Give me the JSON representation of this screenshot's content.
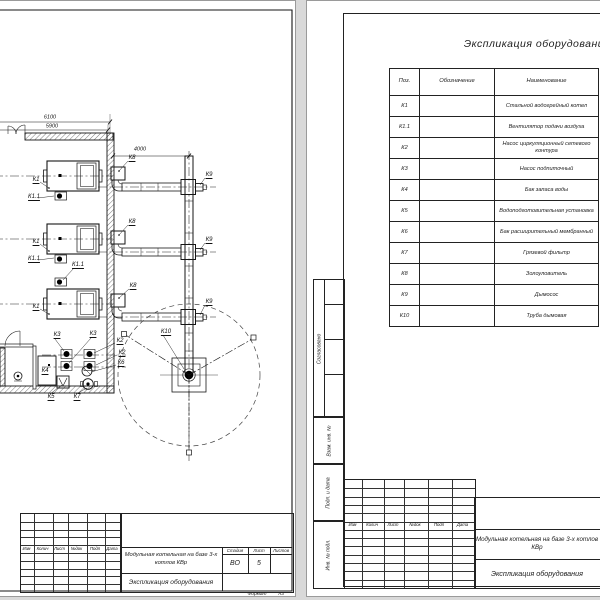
{
  "plan": {
    "labels": [
      {
        "t": "6100",
        "x": 50,
        "y": 117,
        "d": 1
      },
      {
        "t": "5900",
        "x": 52,
        "y": 126,
        "d": 1
      },
      {
        "t": "4000",
        "x": 140,
        "y": 149,
        "d": 1
      },
      {
        "t": "К1",
        "x": 36,
        "y": 179
      },
      {
        "t": "К1",
        "x": 36,
        "y": 241
      },
      {
        "t": "К1",
        "x": 36,
        "y": 306
      },
      {
        "t": "К1.1",
        "x": 34,
        "y": 196
      },
      {
        "t": "К1.1",
        "x": 34,
        "y": 258
      },
      {
        "t": "К1.1",
        "x": 78,
        "y": 264
      },
      {
        "t": "К8",
        "x": 132,
        "y": 157
      },
      {
        "t": "К8",
        "x": 132,
        "y": 221
      },
      {
        "t": "К8",
        "x": 133,
        "y": 285
      },
      {
        "t": "К9",
        "x": 209,
        "y": 174
      },
      {
        "t": "К9",
        "x": 209,
        "y": 239
      },
      {
        "t": "К9",
        "x": 209,
        "y": 301
      },
      {
        "t": "К10",
        "x": 166,
        "y": 331
      },
      {
        "t": "К3",
        "x": 57,
        "y": 334
      },
      {
        "t": "К3",
        "x": 93,
        "y": 333
      },
      {
        "t": "К2",
        "x": 120,
        "y": 340
      },
      {
        "t": "К2",
        "x": 122,
        "y": 352
      },
      {
        "t": "К6",
        "x": 121,
        "y": 362
      },
      {
        "t": "К4",
        "x": 45,
        "y": 370
      },
      {
        "t": "К5",
        "x": 51,
        "y": 396
      },
      {
        "t": "К7",
        "x": 77,
        "y": 396
      }
    ]
  },
  "equip_table": {
    "title": "Экспликация оборудования",
    "headers": [
      "Поз.",
      "Обозначение",
      "Наименование"
    ],
    "rows": [
      [
        "К1",
        "",
        "Стальной водогрейный котел"
      ],
      [
        "К1.1",
        "",
        "Вентилятор подачи воздуха"
      ],
      [
        "К2",
        "",
        "Насос циркуляционный сетевого контура"
      ],
      [
        "К3",
        "",
        "Насос подпиточный"
      ],
      [
        "К4",
        "",
        "Бак запаса воды"
      ],
      [
        "К5",
        "",
        "Водоподготовительная установка"
      ],
      [
        "К6",
        "",
        "Бак расширительный мембранный"
      ],
      [
        "К7",
        "",
        "Грязевой фильтр"
      ],
      [
        "К8",
        "",
        "Золоуловитель"
      ],
      [
        "К9",
        "",
        "Дымосос"
      ],
      [
        "К10",
        "",
        "Труба дымовая"
      ]
    ]
  },
  "left_titleblock": {
    "rev_headers": [
      "Изм",
      "Колич",
      "Лист",
      "№док",
      "Подп",
      "Дата"
    ],
    "project": "Модульная котельная на базе 3-х котлов КВр",
    "doc_title": "Экспликация оборудования",
    "stage_label": "Стадия",
    "sheet_label": "Лист",
    "sheets_label": "Листов",
    "stage": "ВО",
    "sheet": "5",
    "format_label": "Формат",
    "format_value": "А3"
  },
  "right_titleblock": {
    "rev_headers": [
      "Изм",
      "Колич",
      "Лист",
      "№док",
      "Подп",
      "Дата"
    ],
    "project": "Модульная котельная на базе 3-х котлов КВр",
    "doc_title": "Экспликация оборудования"
  },
  "side_stamp": {
    "labels": [
      "Согласовано",
      "Взам. инв. №",
      "Подп. и дата",
      "Инв. № подл."
    ]
  }
}
